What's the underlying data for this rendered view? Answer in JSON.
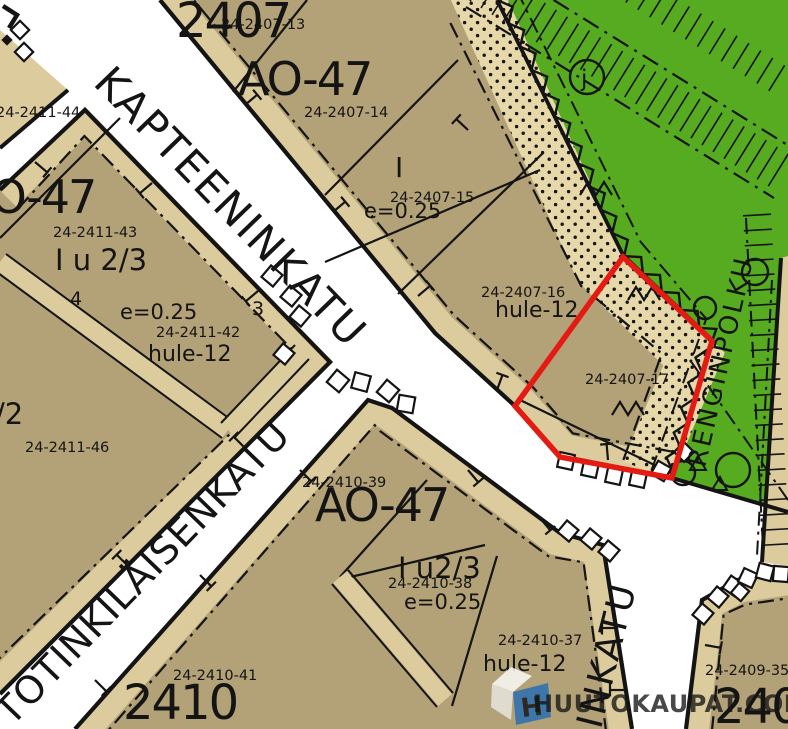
{
  "streets": {
    "kapteeninkatu": "KAPTEENINKATU",
    "totinkilaisenkatu": "TOTINKILÄISENKATU",
    "renginpolku": "RENGINPOLKU",
    "rinkatu": "RINKATU"
  },
  "green_path_marker": "j",
  "blocks": {
    "b2407": {
      "number": "2407",
      "zone": "AO-47",
      "p13": "24-2407-13",
      "p14": "24-2407-14",
      "p15": "24-2407-15",
      "p16": "24-2407-16",
      "p17": "24-2407-17",
      "floors": "I",
      "eff": "e=0.25",
      "hule": "hule-12"
    },
    "b2411": {
      "zone": "AO-47",
      "p44": "24-2411-44",
      "p43": "24-2411-43",
      "p42": "24-2411-42",
      "p46": "24-2411-46",
      "floors": "I u 2/3",
      "floors_partial": "/2",
      "eff": "e=0.25",
      "hule": "hule-12",
      "site4": "4",
      "site3": "3"
    },
    "b2410": {
      "number": "2410",
      "zone": "AO-47",
      "p39": "24-2410-39",
      "p38": "24-2410-38",
      "p37": "24-2410-37",
      "p41": "24-2410-41",
      "floors": "I u2/3",
      "eff": "e=0.25",
      "hule": "hule-12"
    },
    "b2409": {
      "number": "2409",
      "p35": "24-2409-35"
    }
  },
  "highlight_parcel": "24-2407-17",
  "watermark": {
    "text": "HUUTOKAUPAT.COM",
    "logo_letter": "H"
  },
  "colors": {
    "parcel_fill": "#b3a277",
    "verge_fill": "#dccb9c",
    "green_fill": "#56ab20",
    "sand_fill": "#e7d8aa",
    "line": "#141414",
    "highlight_red": "#e51a12",
    "watermark_blue": "#2a6fb4",
    "white": "#ffffff"
  }
}
